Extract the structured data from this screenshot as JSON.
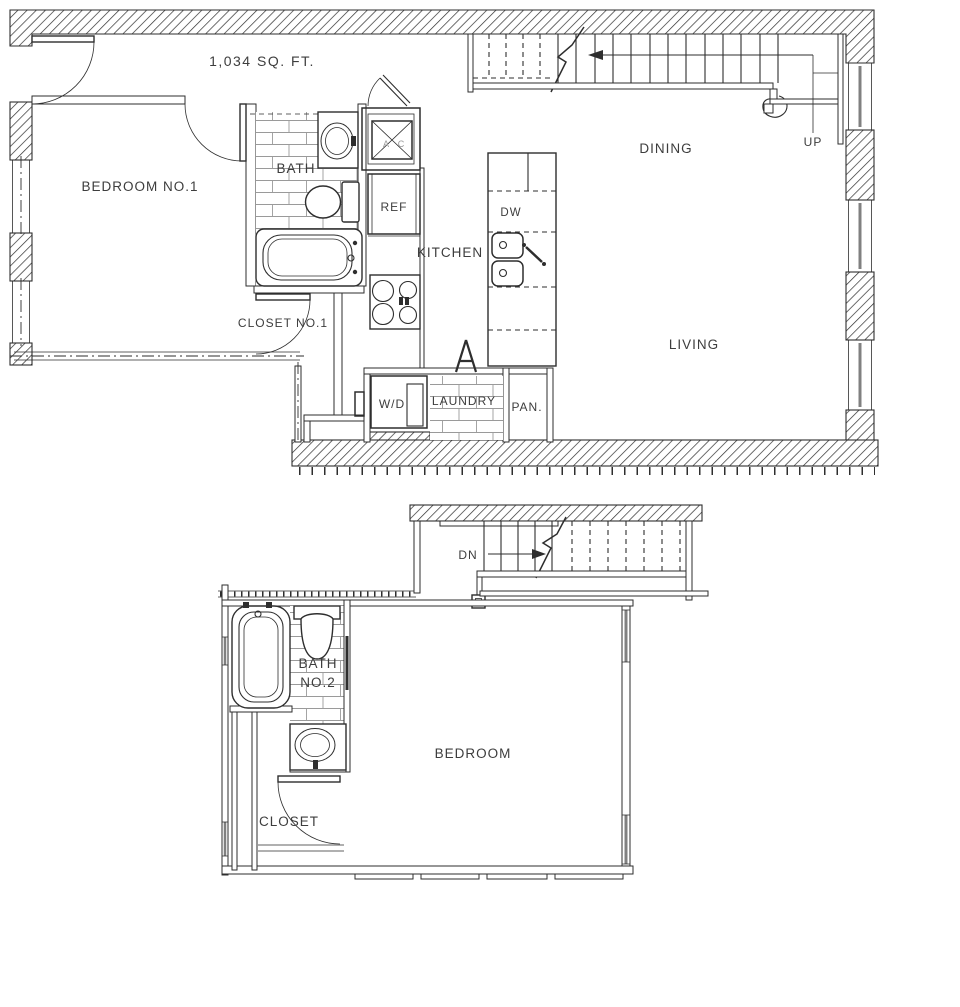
{
  "plan": {
    "area_label": "1,034 SQ. FT.",
    "upper_floor": {
      "bedroom1": "BEDROOM NO.1",
      "bath": "BATH",
      "closet1": "CLOSET NO.1",
      "kitchen": "KITCHEN",
      "ref": "REF",
      "ac_left": "A",
      "ac_right": "C",
      "dw": "DW",
      "dining": "DINING",
      "living": "LIVING",
      "up": "UP",
      "wd": "W/D",
      "laundry": "LAUNDRY",
      "pantry": "PAN."
    },
    "lower_floor": {
      "dn": "DN",
      "bath2_line1": "BATH",
      "bath2_line2": "NO.2",
      "bedroom": "BEDROOM",
      "closet": "CLOSET"
    },
    "colors": {
      "line": "#2e2e2e",
      "text": "#3d3d3d",
      "tile": "#9a9a9a",
      "window": "#808080",
      "paper": "#ffffff"
    }
  }
}
